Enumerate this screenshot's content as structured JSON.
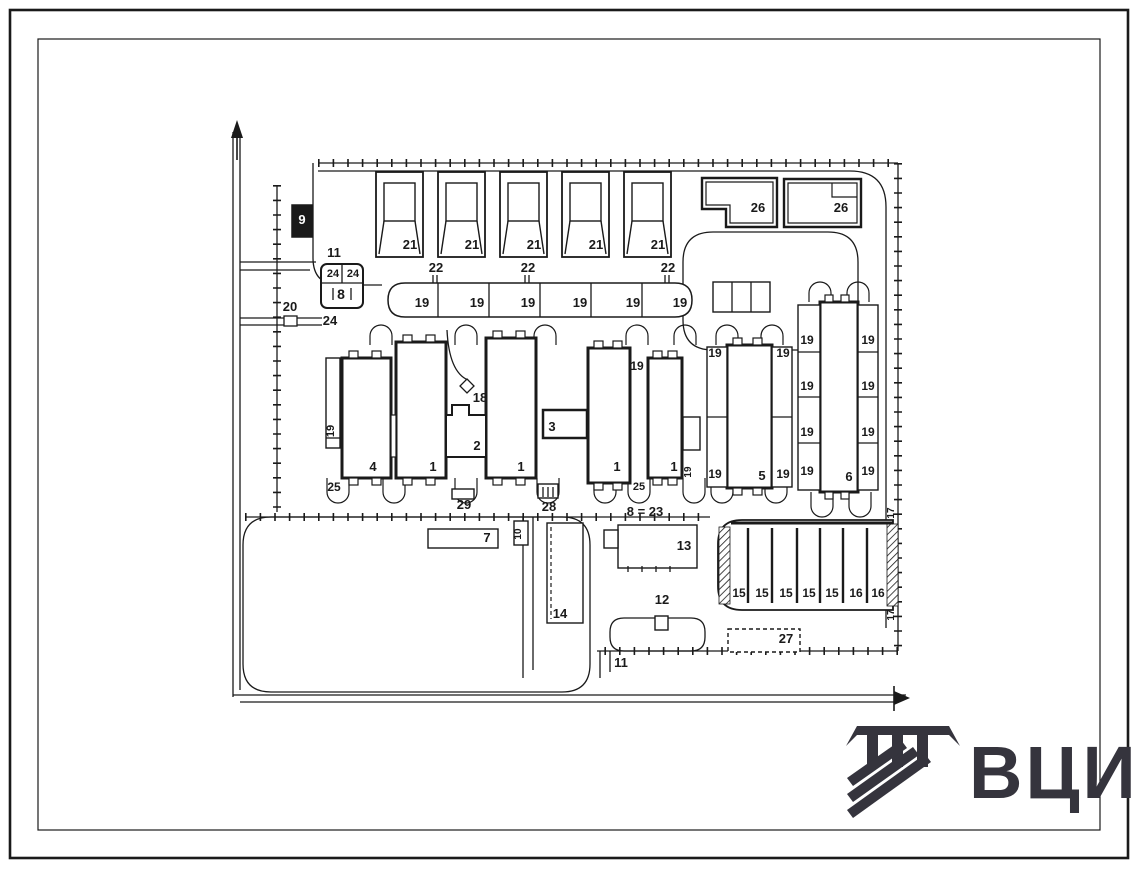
{
  "meta": {
    "type": "site-plan-technical-drawing",
    "colors": {
      "background": "#ffffff",
      "line": "#1a1a1a",
      "logo": "#35343d"
    }
  },
  "logo": {
    "text": "ВЦИС"
  },
  "frame": {
    "outer": [
      10,
      10,
      1118,
      848
    ],
    "inner": [
      38,
      39,
      1062,
      791
    ]
  },
  "fences": [
    [
      318,
      163,
      898,
      163
    ],
    [
      898,
      163,
      898,
      651
    ],
    [
      898,
      651,
      597,
      651
    ],
    [
      277,
      185,
      277,
      512
    ],
    [
      245,
      517,
      710,
      517
    ]
  ],
  "roads": [
    "M233,132 L233,697",
    "M240,132 L240,690",
    "M240,262 L316,262",
    "M240,270 L310,270",
    "M240,318 L322,318",
    "M240,325 L322,325",
    "M233,695 L906,695",
    "M240,702 L898,702",
    "M313,163 L313,258 Q313,285 340,285 L382,285",
    "M318,171 L850,171 Q886,171 886,207 L886,628",
    "M713,232 L828,232 Q858,232 858,262 L858,320 Q858,350 828,350 L713,350 Q683,350 683,320 L683,262 Q683,232 713,232 Z",
    "M271,517 L562,517 Q590,517 590,545 L590,664 Q590,692 562,692 L271,692 Q243,692 243,664 L243,545 Q243,517 271,517 Z",
    "M624,618 L691,618 Q705,618 705,632 L705,637 Q705,651 691,651 L624,651 Q610,651 610,637 L610,632 Q610,618 624,618 Z",
    "M523,517 L523,678",
    "M533,517 L533,670",
    "M600,651 L600,678",
    "M610,651 L610,672",
    "M447,330 Q449,372 468,380"
  ],
  "u_loops_bottom": [
    [
      338,
      478
    ],
    [
      394,
      478
    ],
    [
      466,
      478
    ],
    [
      548,
      478
    ],
    [
      605,
      478
    ],
    [
      639,
      478
    ],
    [
      694,
      478
    ],
    [
      722,
      478
    ],
    [
      776,
      478
    ],
    [
      822,
      492
    ],
    [
      860,
      492
    ]
  ],
  "u_loops_top": [
    [
      381,
      345
    ],
    [
      466,
      345
    ],
    [
      545,
      345
    ],
    [
      637,
      345
    ],
    [
      685,
      345
    ],
    [
      727,
      345
    ],
    [
      772,
      345
    ],
    [
      820,
      302
    ],
    [
      858,
      302
    ]
  ],
  "garages": {
    "y": 172,
    "w": 47,
    "h": 85,
    "xs": [
      376,
      438,
      500,
      562,
      624
    ]
  },
  "b26": {
    "a_outer": "M702,178 L777,178 L777,227 L726,227 L726,209 L702,209 Z",
    "a_inner": "M706,182 L773,182 L773,223 L730,223 L730,205 L706,205 Z",
    "b_outer": "M784,179 L861,179 L861,227 L784,227 Z",
    "b_inner": "M788,183 L857,183 L857,223 L788,223 Z",
    "b_notch": "M832,183 L832,197 L857,197"
  },
  "strip19_path": "M405,283 L675,283 Q692,283 692,300 Q692,317 675,317 L405,317 Q388,317 388,300 Q388,283 405,283 Z",
  "rects": [
    {
      "n": "kiosk-9",
      "x": 292,
      "y": 205,
      "w": 20,
      "h": 32,
      "sw": 1.5,
      "fill": "#1a1a1a"
    },
    {
      "n": "gate-20",
      "x": 284,
      "y": 316,
      "w": 13,
      "h": 10,
      "sw": 1.3
    },
    {
      "n": "box-8",
      "x": 321,
      "y": 264,
      "w": 42,
      "h": 44,
      "sw": 2,
      "r": 6
    },
    {
      "n": "cells-3bay",
      "x": 713,
      "y": 282,
      "w": 57,
      "h": 30,
      "sw": 1.4
    },
    {
      "n": "strip-annex-19",
      "x": 326,
      "y": 358,
      "w": 14,
      "h": 90,
      "sw": 1.4
    },
    {
      "n": "building-4",
      "x": 342,
      "y": 358,
      "w": 49,
      "h": 120,
      "sw": 3
    },
    {
      "n": "building-1a",
      "x": 396,
      "y": 342,
      "w": 50,
      "h": 136,
      "sw": 3
    },
    {
      "n": "connector-ab",
      "x": 391,
      "y": 415,
      "w": 5,
      "h": 42,
      "sw": 1.2
    },
    {
      "n": "building-1b",
      "x": 486,
      "y": 338,
      "w": 50,
      "h": 140,
      "sw": 3
    },
    {
      "n": "building-3",
      "x": 543,
      "y": 410,
      "w": 44,
      "h": 28,
      "sw": 2.5
    },
    {
      "n": "building-1c",
      "x": 588,
      "y": 348,
      "w": 42,
      "h": 135,
      "sw": 3
    },
    {
      "n": "building-1d",
      "x": 648,
      "y": 358,
      "w": 34,
      "h": 120,
      "sw": 3
    },
    {
      "n": "annex-e",
      "x": 683,
      "y": 417,
      "w": 17,
      "h": 33,
      "sw": 1.4
    },
    {
      "n": "building-5",
      "x": 727,
      "y": 345,
      "w": 45,
      "h": 143,
      "sw": 3
    },
    {
      "n": "wing-5-left",
      "x": 707,
      "y": 347,
      "w": 20,
      "h": 140,
      "sw": 1.4
    },
    {
      "n": "wing-5-right",
      "x": 772,
      "y": 347,
      "w": 20,
      "h": 140,
      "sw": 1.4
    },
    {
      "n": "building-6",
      "x": 820,
      "y": 302,
      "w": 38,
      "h": 190,
      "sw": 3
    },
    {
      "n": "wing-6-left",
      "x": 798,
      "y": 305,
      "w": 22,
      "h": 185,
      "sw": 1.4
    },
    {
      "n": "wing-6-right",
      "x": 858,
      "y": 305,
      "w": 20,
      "h": 185,
      "sw": 1.4
    },
    {
      "n": "structure-29",
      "x": 452,
      "y": 489,
      "w": 22,
      "h": 10,
      "sw": 1.4
    },
    {
      "n": "structure-28",
      "x": 538,
      "y": 484,
      "w": 20,
      "h": 14,
      "sw": 1.4
    },
    {
      "n": "structure-7",
      "x": 428,
      "y": 529,
      "w": 70,
      "h": 19,
      "sw": 1.4
    },
    {
      "n": "structure-10",
      "x": 514,
      "y": 521,
      "w": 14,
      "h": 24,
      "sw": 1.4
    },
    {
      "n": "structure-13",
      "x": 618,
      "y": 525,
      "w": 79,
      "h": 43,
      "sw": 1.4
    },
    {
      "n": "structure-13-annex",
      "x": 604,
      "y": 530,
      "w": 14,
      "h": 18,
      "sw": 1.4
    },
    {
      "n": "structure-14",
      "x": 547,
      "y": 523,
      "w": 36,
      "h": 100,
      "sw": 1.4
    },
    {
      "n": "structure-12",
      "x": 655,
      "y": 616,
      "w": 13,
      "h": 14,
      "sw": 1.4
    },
    {
      "n": "structure-27",
      "x": 728,
      "y": 629,
      "w": 72,
      "h": 23,
      "sw": 1.4,
      "dash": "4 3"
    }
  ],
  "conn2_path": "M446,415 L452,415 L452,405 L469,405 L469,415 L486,415 L486,457 L446,457 Z",
  "diamond18": "467,379 474,386 467,393 460,386",
  "parking": {
    "outer": "M742,520 L893,520 L893,610 L742,610 Q718,610 718,586 L718,544 Q718,520 742,520 Z",
    "top_line": [
      731,
      523,
      893,
      523
    ],
    "dividers_x": [
      748,
      772,
      797,
      820,
      843,
      867
    ],
    "div_y": [
      528,
      603
    ],
    "hatch_left": [
      719,
      527,
      11,
      77
    ],
    "hatch_right": [
      887,
      524,
      11,
      82
    ]
  },
  "lines": [
    [
      438,
      283,
      438,
      317
    ],
    [
      489,
      283,
      489,
      317
    ],
    [
      540,
      283,
      540,
      317
    ],
    [
      591,
      283,
      591,
      317
    ],
    [
      642,
      283,
      642,
      317
    ],
    [
      433,
      275,
      433,
      283
    ],
    [
      437,
      275,
      437,
      283
    ],
    [
      525,
      275,
      525,
      283
    ],
    [
      529,
      275,
      529,
      283
    ],
    [
      665,
      275,
      665,
      283
    ],
    [
      669,
      275,
      669,
      283
    ],
    [
      732,
      282,
      732,
      312
    ],
    [
      751,
      282,
      751,
      312
    ],
    [
      326,
      438,
      340,
      438
    ],
    [
      342,
      264,
      342,
      283
    ],
    [
      321,
      283,
      363,
      283
    ],
    [
      333,
      288,
      333,
      300
    ],
    [
      351,
      288,
      351,
      300
    ],
    [
      707,
      417,
      727,
      417
    ],
    [
      772,
      417,
      792,
      417
    ],
    [
      798,
      352,
      820,
      352
    ],
    [
      798,
      397,
      820,
      397
    ],
    [
      798,
      443,
      820,
      443
    ],
    [
      858,
      352,
      878,
      352
    ],
    [
      858,
      397,
      878,
      397
    ],
    [
      858,
      443,
      878,
      443
    ],
    [
      543,
      487,
      543,
      497
    ],
    [
      548,
      487,
      548,
      497
    ],
    [
      553,
      487,
      553,
      497
    ],
    [
      628,
      566,
      628,
      572
    ],
    [
      642,
      566,
      642,
      572
    ],
    [
      656,
      566,
      656,
      572
    ],
    [
      670,
      566,
      670,
      572
    ]
  ],
  "dashed_lines": [
    {
      "p": [
        551,
        527,
        551,
        619
      ],
      "dash": "4 3"
    }
  ],
  "stubs": [
    [
      349,
      351,
      9,
      7
    ],
    [
      372,
      351,
      9,
      7
    ],
    [
      349,
      478,
      9,
      7
    ],
    [
      372,
      478,
      9,
      7
    ],
    [
      403,
      335,
      9,
      7
    ],
    [
      426,
      335,
      9,
      7
    ],
    [
      403,
      478,
      9,
      7
    ],
    [
      426,
      478,
      9,
      7
    ],
    [
      493,
      331,
      9,
      7
    ],
    [
      516,
      331,
      9,
      7
    ],
    [
      493,
      478,
      9,
      7
    ],
    [
      516,
      478,
      9,
      7
    ],
    [
      594,
      341,
      9,
      7
    ],
    [
      613,
      341,
      9,
      7
    ],
    [
      594,
      483,
      9,
      7
    ],
    [
      613,
      483,
      9,
      7
    ],
    [
      653,
      351,
      9,
      7
    ],
    [
      668,
      351,
      9,
      7
    ],
    [
      653,
      478,
      9,
      7
    ],
    [
      668,
      478,
      9,
      7
    ],
    [
      733,
      338,
      9,
      7
    ],
    [
      753,
      338,
      9,
      7
    ],
    [
      733,
      488,
      9,
      7
    ],
    [
      753,
      488,
      9,
      7
    ],
    [
      825,
      295,
      8,
      7
    ],
    [
      841,
      295,
      8,
      7
    ],
    [
      825,
      492,
      8,
      7
    ],
    [
      841,
      492,
      8,
      7
    ]
  ],
  "north_arrow": {
    "shaft": "M237,160 L237,128",
    "head": "231,138 237,120 243,138"
  },
  "exit_arrow": {
    "head": "894,691 910,698 894,705",
    "bar": "M894,686 L894,711"
  },
  "labels": [
    {
      "t": "9",
      "x": 302,
      "y": 224,
      "white": true
    },
    {
      "t": "11",
      "x": 334,
      "y": 257
    },
    {
      "t": "24",
      "x": 333,
      "y": 277,
      "s": 11
    },
    {
      "t": "24",
      "x": 353,
      "y": 277,
      "s": 11
    },
    {
      "t": "8",
      "x": 341,
      "y": 299,
      "s": 14
    },
    {
      "t": "20",
      "x": 290,
      "y": 311
    },
    {
      "t": "24",
      "x": 330,
      "y": 325
    },
    {
      "t": "21",
      "x": 410,
      "y": 249
    },
    {
      "t": "21",
      "x": 472,
      "y": 249
    },
    {
      "t": "21",
      "x": 534,
      "y": 249
    },
    {
      "t": "21",
      "x": 596,
      "y": 249
    },
    {
      "t": "21",
      "x": 658,
      "y": 249
    },
    {
      "t": "26",
      "x": 758,
      "y": 212
    },
    {
      "t": "26",
      "x": 841,
      "y": 212
    },
    {
      "t": "22",
      "x": 436,
      "y": 272
    },
    {
      "t": "22",
      "x": 528,
      "y": 272
    },
    {
      "t": "22",
      "x": 668,
      "y": 272
    },
    {
      "t": "19",
      "x": 422,
      "y": 307
    },
    {
      "t": "19",
      "x": 477,
      "y": 307
    },
    {
      "t": "19",
      "x": 528,
      "y": 307
    },
    {
      "t": "19",
      "x": 580,
      "y": 307
    },
    {
      "t": "19",
      "x": 633,
      "y": 307
    },
    {
      "t": "19",
      "x": 680,
      "y": 307
    },
    {
      "t": "18",
      "x": 480,
      "y": 402
    },
    {
      "t": "19",
      "x": 334,
      "y": 431,
      "r": -90,
      "s": 11
    },
    {
      "t": "25",
      "x": 334,
      "y": 491,
      "s": 12
    },
    {
      "t": "4",
      "x": 373,
      "y": 471
    },
    {
      "t": "1",
      "x": 433,
      "y": 471
    },
    {
      "t": "2",
      "x": 477,
      "y": 450
    },
    {
      "t": "1",
      "x": 521,
      "y": 471
    },
    {
      "t": "3",
      "x": 552,
      "y": 431
    },
    {
      "t": "19",
      "x": 637,
      "y": 370,
      "s": 12
    },
    {
      "t": "1",
      "x": 617,
      "y": 471
    },
    {
      "t": "25",
      "x": 639,
      "y": 490,
      "s": 11
    },
    {
      "t": "1",
      "x": 674,
      "y": 471
    },
    {
      "t": "19",
      "x": 691,
      "y": 472,
      "r": -90,
      "s": 10
    },
    {
      "t": "19",
      "x": 715,
      "y": 357,
      "s": 12
    },
    {
      "t": "19",
      "x": 783,
      "y": 357,
      "s": 12
    },
    {
      "t": "19",
      "x": 715,
      "y": 478,
      "s": 12
    },
    {
      "t": "19",
      "x": 783,
      "y": 478,
      "s": 12
    },
    {
      "t": "5",
      "x": 762,
      "y": 480
    },
    {
      "t": "19",
      "x": 807,
      "y": 344,
      "s": 12
    },
    {
      "t": "19",
      "x": 807,
      "y": 390,
      "s": 12
    },
    {
      "t": "19",
      "x": 807,
      "y": 436,
      "s": 12
    },
    {
      "t": "19",
      "x": 807,
      "y": 475,
      "s": 12
    },
    {
      "t": "19",
      "x": 868,
      "y": 344,
      "s": 12
    },
    {
      "t": "19",
      "x": 868,
      "y": 390,
      "s": 12
    },
    {
      "t": "19",
      "x": 868,
      "y": 436,
      "s": 12
    },
    {
      "t": "19",
      "x": 868,
      "y": 475,
      "s": 12
    },
    {
      "t": "6",
      "x": 849,
      "y": 481
    },
    {
      "t": "29",
      "x": 464,
      "y": 509
    },
    {
      "t": "28",
      "x": 549,
      "y": 511
    },
    {
      "t": "7",
      "x": 487,
      "y": 542
    },
    {
      "t": "10",
      "x": 521,
      "y": 534,
      "r": -90,
      "s": 10
    },
    {
      "t": "8 = 23",
      "x": 645,
      "y": 516
    },
    {
      "t": "13",
      "x": 684,
      "y": 550
    },
    {
      "t": "14",
      "x": 560,
      "y": 618
    },
    {
      "t": "12",
      "x": 662,
      "y": 604
    },
    {
      "t": "11",
      "x": 621,
      "y": 667
    },
    {
      "t": "27",
      "x": 786,
      "y": 643
    },
    {
      "t": "15",
      "x": 739,
      "y": 597,
      "s": 12
    },
    {
      "t": "15",
      "x": 762,
      "y": 597,
      "s": 12
    },
    {
      "t": "15",
      "x": 786,
      "y": 597,
      "s": 12
    },
    {
      "t": "15",
      "x": 809,
      "y": 597,
      "s": 12
    },
    {
      "t": "15",
      "x": 832,
      "y": 597,
      "s": 12
    },
    {
      "t": "16",
      "x": 856,
      "y": 597,
      "s": 12
    },
    {
      "t": "16",
      "x": 878,
      "y": 597,
      "s": 12
    },
    {
      "t": "17",
      "x": 894,
      "y": 513,
      "r": -90,
      "s": 10
    },
    {
      "t": "17",
      "x": 894,
      "y": 615,
      "r": -90,
      "s": 10
    }
  ],
  "logo_emblem": {
    "bar": "14,4 106,4 106,13 14,13",
    "flare_left": "14,4 3,24 14,13",
    "flare_right": "106,4 117,24 106,13",
    "teeth": [
      [
        24,
        13,
        11,
        32
      ],
      [
        49,
        13,
        11,
        32
      ],
      [
        74,
        13,
        11,
        32
      ]
    ],
    "stripes": [
      "4,56 58,18 64,26 10,64",
      "4,72 70,25 76,33 10,80",
      "4,88 82,32 88,40 10,96"
    ]
  }
}
